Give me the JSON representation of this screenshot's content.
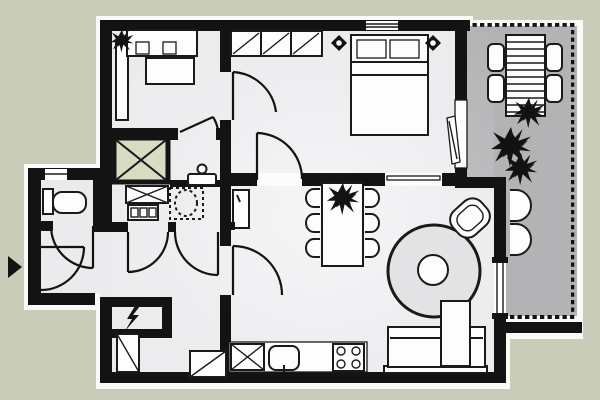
{
  "canvas": {
    "width": 600,
    "height": 400
  },
  "colors": {
    "background": "#c9ccb8",
    "halo": "#fafaf7",
    "wall": "#131313",
    "floor_light": "#ebebee",
    "terrace_floor": "#b3b3b6",
    "shaft_fill": "#d9dbc3",
    "furniture_fill": "#fdfdfd",
    "furniture_stroke": "#1a1a1a",
    "rug_fill": "#e3e3e6"
  },
  "plan": {
    "rooms": [
      "bedroom-1",
      "dressing-area",
      "bedroom-2",
      "bathroom",
      "wc",
      "entrance-hall",
      "corridor",
      "storage-room",
      "living-room",
      "kitchen",
      "terrace"
    ],
    "symbols": [
      "entrance-arrow",
      "electrical-panel-lightning",
      "shaft-cross",
      "door-swing-arcs",
      "dotted-railing"
    ],
    "furniture": [
      "single-bed",
      "wardrobe",
      "built-in-closet",
      "double-bed",
      "wall-lamps",
      "toilet",
      "washbasin",
      "vanity-unit",
      "washing-machine",
      "dining-table",
      "six-chairs",
      "plant",
      "round-rug",
      "armchair",
      "corner-sofa",
      "kitchen-counter",
      "sink",
      "stove",
      "terrace-table",
      "terrace-chairs",
      "lounge-chairs"
    ]
  }
}
